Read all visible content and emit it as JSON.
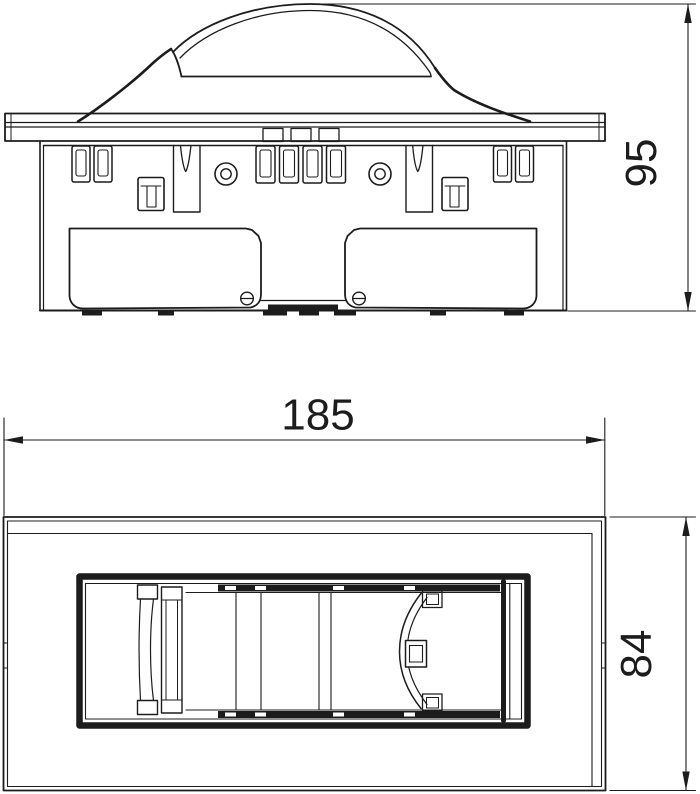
{
  "page": {
    "background": "#ffffff",
    "line_color": "#1c1c1c"
  },
  "dimensions": {
    "side_height": {
      "value": "95",
      "orientation": "vertical"
    },
    "plan_width": {
      "value": "185",
      "orientation": "horizontal"
    },
    "plan_depth": {
      "value": "84",
      "orientation": "vertical"
    }
  }
}
